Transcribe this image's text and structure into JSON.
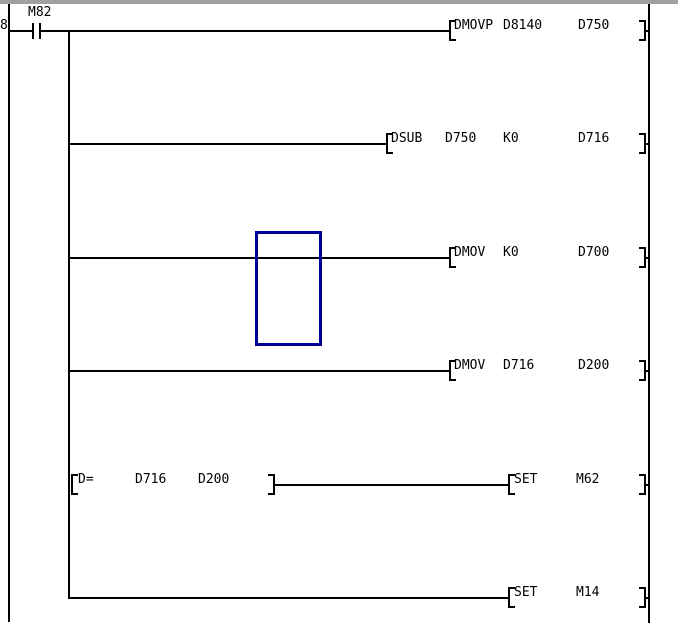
{
  "window": {
    "step_number": "8",
    "colors": {
      "background": "#ffffff",
      "line": "#000000",
      "selection_cursor": "#000099",
      "top_border": "#a0a0a0"
    }
  },
  "ladder": {
    "contact": {
      "label": "M82"
    },
    "rungs": [
      {
        "type": "output",
        "instruction": "DMOVP",
        "op1": "D8140",
        "op2": "D750"
      },
      {
        "type": "output",
        "instruction": "DSUB",
        "op1": "D750",
        "op2": "K0",
        "op3": "D716"
      },
      {
        "type": "output",
        "instruction": "DMOV",
        "op1": "K0",
        "op2": "D700"
      },
      {
        "type": "output",
        "instruction": "DMOV",
        "op1": "D716",
        "op2": "D200"
      },
      {
        "type": "compare-output",
        "compare": {
          "instruction": "D=",
          "op1": "D716",
          "op2": "D200"
        },
        "output": {
          "instruction": "SET",
          "op1": "M62"
        }
      },
      {
        "type": "output",
        "instruction": "SET",
        "op1": "M14"
      }
    ]
  }
}
